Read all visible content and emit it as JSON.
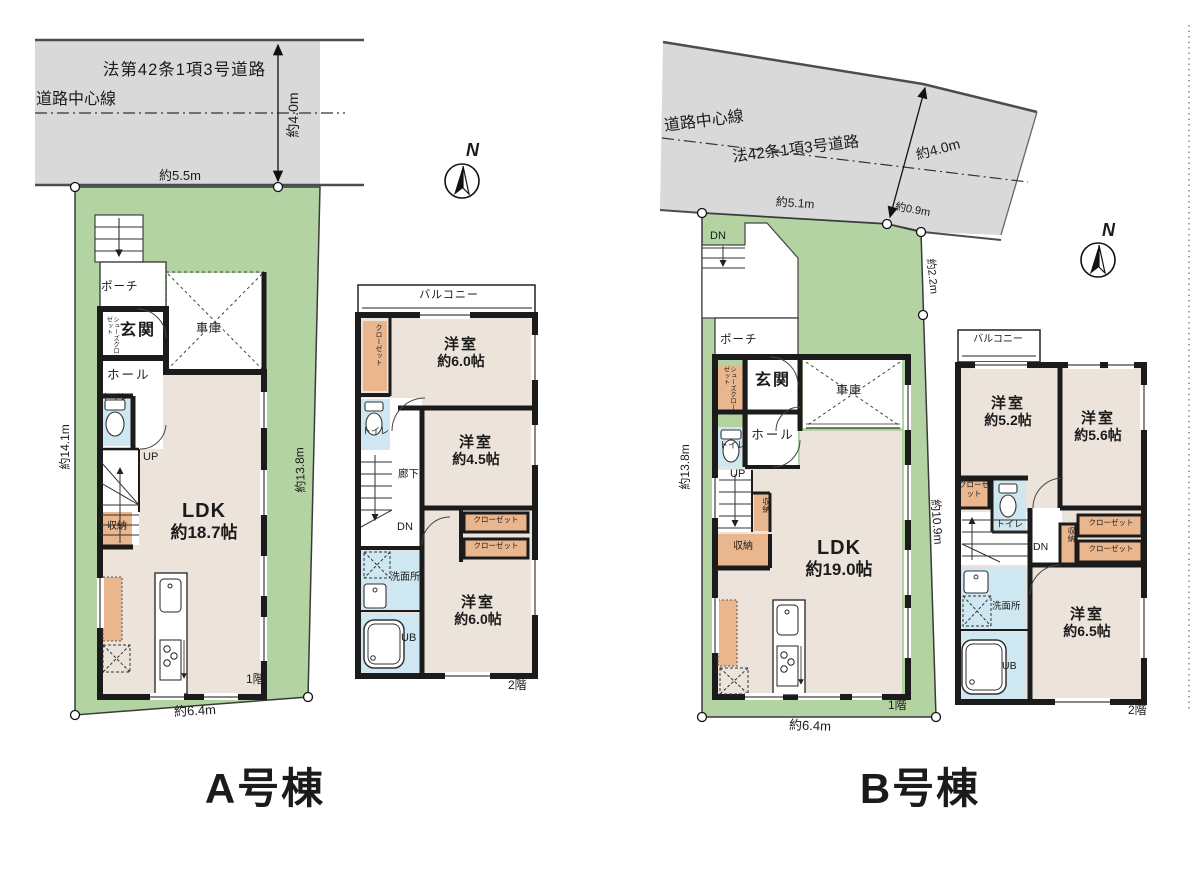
{
  "colors": {
    "site_green": "#b3d3a2",
    "road_gray": "#d9d9d9",
    "floor_beige": "#ece4db",
    "closet_orange": "#eab68e",
    "wet_area_blue": "#cfe7f0",
    "wall_black": "#1b1b1b"
  },
  "buildings": {
    "a": {
      "title": "A号棟",
      "compass": "N",
      "road": {
        "law": "法第42条1項3号道路",
        "centerline": "道路中心線",
        "width": "約4.0m",
        "frontage": "約5.5m"
      },
      "site": {
        "left": "約14.1m",
        "right": "約13.8m",
        "bottom": "約6.4m"
      },
      "f1": {
        "floor": "1階",
        "porch": "ポーチ",
        "shoes_closet": "シューズクローゼット",
        "entrance": "玄関",
        "hall": "ホール",
        "toilet": "トイレ",
        "garage": "車庫",
        "up": "UP",
        "storage": "収納",
        "ldk": "LDK",
        "ldk_size": "約18.7帖"
      },
      "f2": {
        "floor": "2階",
        "balcony": "バルコニー",
        "closet": "クローゼット",
        "room1": "洋室",
        "room1_size": "約6.0帖",
        "room2": "洋室",
        "room2_size": "約4.5帖",
        "hallway": "廊下",
        "dn": "DN",
        "toilet": "トイレ",
        "closet1": "クローゼット",
        "closet2": "クローゼット",
        "washroom": "洗面所",
        "bath": "UB",
        "room3": "洋室",
        "room3_size": "約6.0帖"
      }
    },
    "b": {
      "title": "B号棟",
      "compass": "N",
      "road": {
        "law": "法42条1項3号道路",
        "centerline": "道路中心線",
        "width": "約4.0m",
        "frontage": "約5.1m",
        "side": "約0.9m"
      },
      "site": {
        "left": "約13.8m",
        "right_top": "約2.2m",
        "right": "約10.9m",
        "bottom": "約6.4m"
      },
      "f1": {
        "floor": "1階",
        "dn": "DN",
        "porch": "ポーチ",
        "shoes_closet": "シューズクローゼット",
        "entrance": "玄関",
        "hall": "ホール",
        "toilet": "トイレ",
        "garage": "車庫",
        "up": "UP",
        "storage_small": "収納",
        "storage": "収納",
        "ldk": "LDK",
        "ldk_size": "約19.0帖"
      },
      "f2": {
        "floor": "2階",
        "balcony": "バルコニー",
        "room1": "洋室",
        "room1_size": "約5.2帖",
        "room2": "洋室",
        "room2_size": "約5.6帖",
        "closet": "クローゼット",
        "toilet": "トイレ",
        "dn": "DN",
        "storage": "収納",
        "closet1": "クローゼット",
        "closet2": "クローゼット",
        "washroom": "洗面所",
        "bath": "UB",
        "room3": "洋室",
        "room3_size": "約6.5帖"
      }
    }
  }
}
